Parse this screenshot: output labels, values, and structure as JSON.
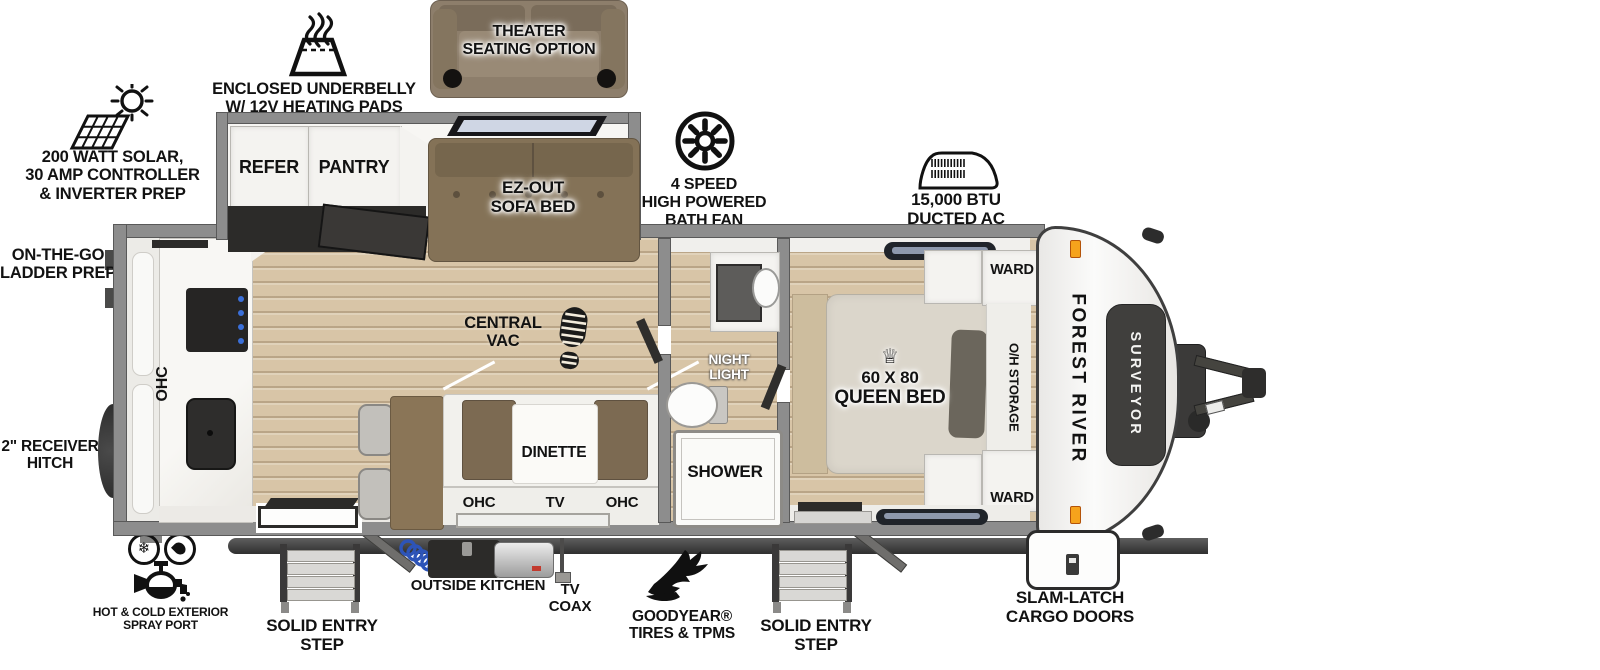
{
  "callouts": {
    "solar": [
      "200 WATT SOLAR,",
      "30 AMP CONTROLLER",
      "& INVERTER PREP"
    ],
    "underbelly": [
      "ENCLOSED UNDERBELLY",
      "W/ 12V HEATING PADS"
    ],
    "theater": [
      "THEATER",
      "SEATING OPTION"
    ],
    "bath_fan": [
      "4 SPEED",
      "HIGH POWERED",
      "BATH FAN"
    ],
    "ducted_ac": [
      "15,000 BTU",
      "DUCTED AC"
    ],
    "ladder": [
      "ON-THE-GO",
      "LADDER PREP"
    ],
    "receiver": [
      "2\" RECEIVER",
      "HITCH"
    ],
    "spray": [
      "HOT & COLD EXTERIOR",
      "SPRAY PORT"
    ],
    "step_left": [
      "SOLID ENTRY",
      "STEP"
    ],
    "outside_kitchen": "OUTSIDE KITCHEN",
    "tv_coax": [
      "TV",
      "COAX"
    ],
    "goodyear": [
      "GOODYEAR®",
      "TIRES & TPMS"
    ],
    "step_right": [
      "SOLID ENTRY",
      "STEP"
    ],
    "cargo": [
      "SLAM-LATCH",
      "CARGO DOORS"
    ]
  },
  "interior": {
    "refer": "REFER",
    "pantry": "PANTRY",
    "sofa": [
      "EZ-OUT",
      "SOFA BED"
    ],
    "central_vac": [
      "CENTRAL",
      "VAC"
    ],
    "dinette": "DINETTE",
    "kitchen_ohc": "OHC",
    "ohc_left": "OHC",
    "tv": "TV",
    "ohc_right": "OHC",
    "night_light": [
      "NIGHT",
      "LIGHT"
    ],
    "shower": "SHOWER",
    "ward_front": "WARD",
    "ward_rear": "WARD",
    "oh_storage": "O/H STORAGE",
    "queen_bed": [
      "60 X 80",
      "QUEEN BED"
    ],
    "crown_icon": "♕",
    "snowflake_icon": "❄"
  },
  "branding": {
    "make": "FOREST RIVER",
    "model": "SURVEYOR"
  }
}
